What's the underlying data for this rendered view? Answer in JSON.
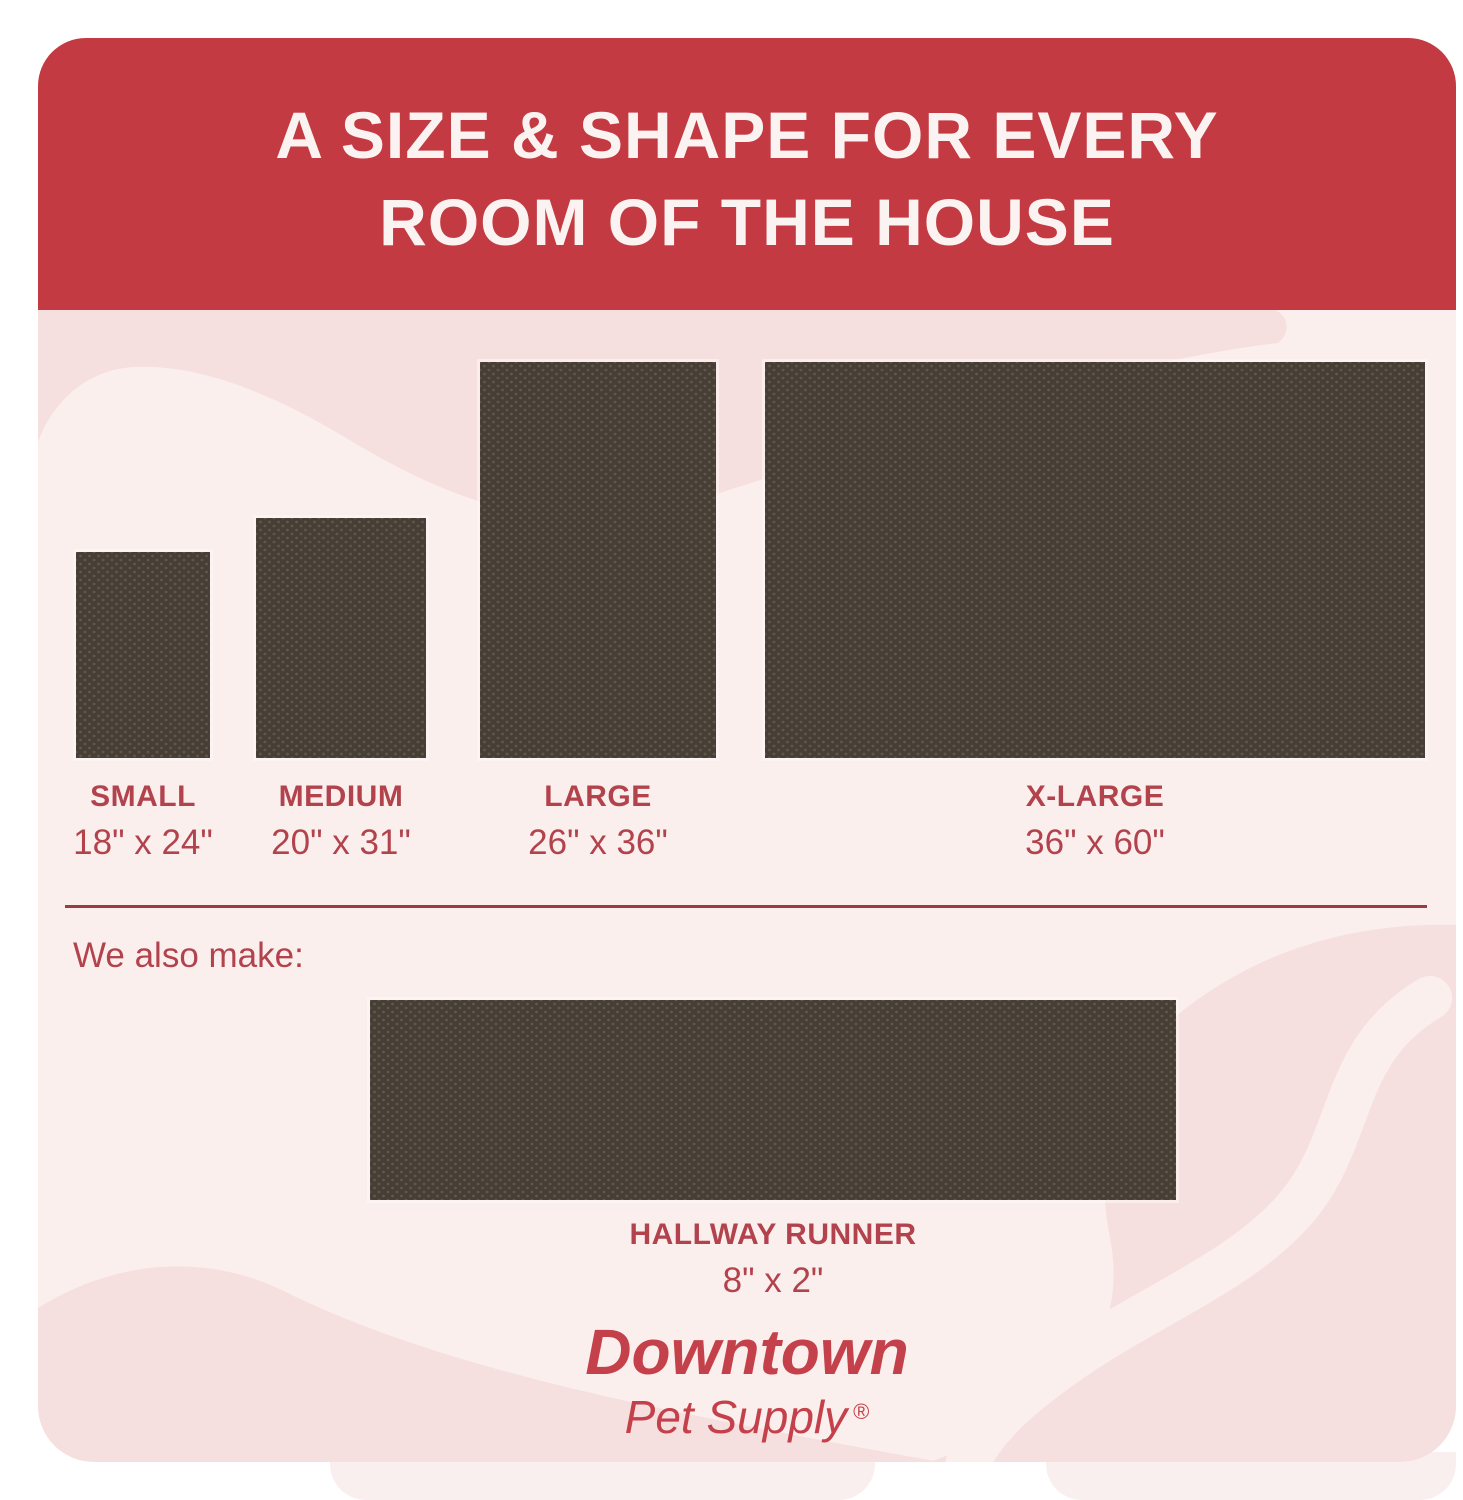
{
  "header": {
    "title_line1": "A SIZE & SHAPE FOR EVERY",
    "title_line2": "ROOM OF THE HOUSE"
  },
  "sizes": [
    {
      "name": "SMALL",
      "dims": "18\" x 24\""
    },
    {
      "name": "MEDIUM",
      "dims": "20\" x 31\""
    },
    {
      "name": "LARGE",
      "dims": "26\" x 36\""
    },
    {
      "name": "X-LARGE",
      "dims": "36\" x 60\""
    }
  ],
  "also_make": {
    "label": "We also make:",
    "runner_name": "HALLWAY RUNNER",
    "runner_dims": "8\" x 2\""
  },
  "brand": {
    "name": "Downtown",
    "tagline": "Pet Supply",
    "registered": "®"
  },
  "colors": {
    "banner-red": "#C33A42",
    "title-cream": "#FBF3F1",
    "panel-pink": "#FBEFED",
    "deco-pink": "#F6E0DF",
    "rug-brown": "#473F35",
    "label-red": "#B2434D",
    "divider-red": "#9C3B42",
    "logo-red": "#C4414B"
  }
}
